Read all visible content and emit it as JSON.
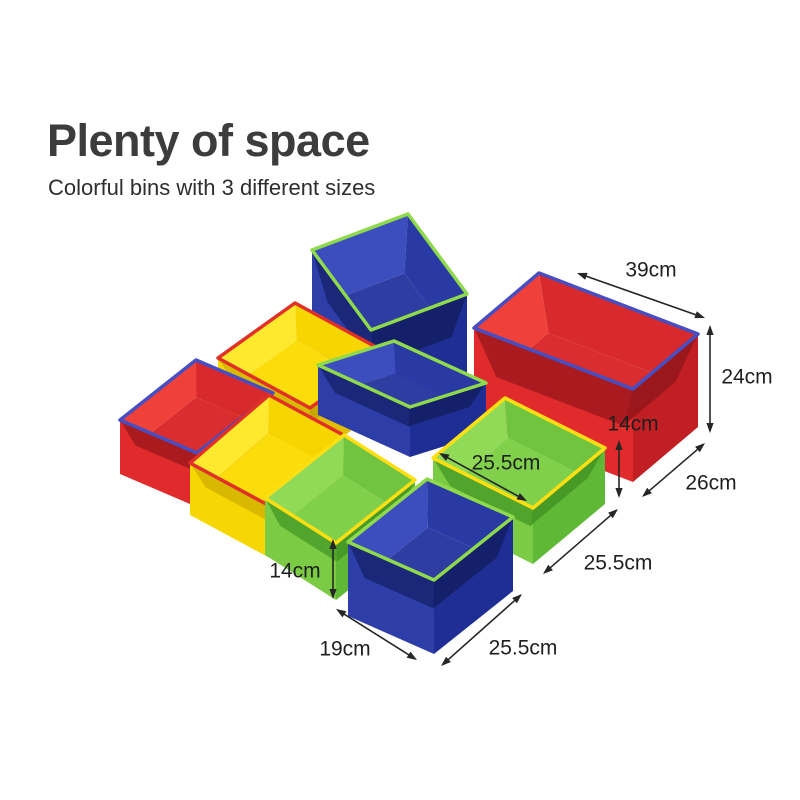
{
  "header": {
    "title": "Plenty of space",
    "subtitle": "Colorful bins with 3 different sizes"
  },
  "palette": {
    "background": "#ffffff",
    "annotation": "#262626",
    "families": {
      "blue": {
        "outer_left": "#2e3ea9",
        "outer_right": "#1f2e95",
        "inner_far_left": "#3c4dbd",
        "inner_far_right": "#2a3aa4",
        "floor": "#2d3da1",
        "inner_near_left": "#1b2779",
        "inner_near_right": "#15206a"
      },
      "red": {
        "outer_left": "#e02a2c",
        "outer_right": "#c11f24",
        "inner_far_left": "#ef403a",
        "inner_far_right": "#d8292d",
        "floor": "#d92d2f",
        "inner_near_left": "#aa1b1f",
        "inner_near_right": "#9a171b"
      },
      "yellow": {
        "outer_left": "#f6d703",
        "outer_right": "#e0bd00",
        "inner_far_left": "#ffe92e",
        "inner_far_right": "#f6d500",
        "floor": "#fadd0a",
        "inner_near_left": "#d9b800",
        "inner_near_right": "#c7a700"
      },
      "green": {
        "outer_left": "#7bcb45",
        "outer_right": "#5fb836",
        "inner_far_left": "#90da58",
        "inner_far_right": "#71c43f",
        "floor": "#80d04b",
        "inner_near_left": "#52a52c",
        "inner_near_right": "#479a26"
      }
    },
    "trims": {
      "green": "#8ed94c",
      "red": "#e03028",
      "blue": "#474ec2",
      "yellow": "#ffdf12"
    }
  },
  "figure": {
    "canvas": {
      "width": 800,
      "height": 800
    },
    "bins": [
      {
        "name": "blue-large-back",
        "color": "blue",
        "trim": "green",
        "front": [
          371,
          330
        ],
        "edge_left": [
          -59,
          -80
        ],
        "edge_right": [
          96,
          -36
        ],
        "height": 92
      },
      {
        "name": "yellow-back",
        "color": "yellow",
        "trim": "red",
        "front": [
          310,
          408
        ],
        "edge_left": [
          -92,
          -50
        ],
        "edge_right": [
          77,
          -55
        ],
        "height": 52
      },
      {
        "name": "red-large-right",
        "color": "red",
        "trim": "blue",
        "front": [
          633,
          389
        ],
        "edge_left": [
          -159,
          -61
        ],
        "edge_right": [
          65,
          -55
        ],
        "height": 93
      },
      {
        "name": "blue-mid",
        "color": "blue",
        "trim": "green",
        "front": [
          410,
          407
        ],
        "edge_left": [
          -92,
          -42
        ],
        "edge_right": [
          76,
          -24
        ],
        "height": 50
      },
      {
        "name": "red-left",
        "color": "red",
        "trim": "blue",
        "front": [
          197,
          453
        ],
        "edge_left": [
          -77,
          -33
        ],
        "edge_right": [
          76,
          -60
        ],
        "height": 54
      },
      {
        "name": "yellow-front",
        "color": "yellow",
        "trim": "red",
        "front": [
          268,
          505
        ],
        "edge_left": [
          -78,
          -42
        ],
        "edge_right": [
          79,
          -68
        ],
        "height": 52
      },
      {
        "name": "green-right",
        "color": "green",
        "trim": "yellow",
        "front": [
          533,
          508
        ],
        "edge_left": [
          -100,
          -50
        ],
        "edge_right": [
          72,
          -60
        ],
        "height": 56
      },
      {
        "name": "green-left",
        "color": "green",
        "trim": "yellow",
        "front": [
          336,
          543
        ],
        "edge_left": [
          -71,
          -45
        ],
        "edge_right": [
          79,
          -63
        ],
        "height": 57
      },
      {
        "name": "blue-front",
        "color": "blue",
        "trim": "green",
        "front": [
          434,
          580
        ],
        "edge_left": [
          -86,
          -38
        ],
        "edge_right": [
          79,
          -63
        ],
        "height": 74
      }
    ],
    "dimensions": [
      {
        "name": "width-39cm",
        "label": "39cm",
        "label_pos": [
          651,
          271
        ],
        "arrow": [
          577,
          273,
          705,
          318
        ]
      },
      {
        "name": "height-24cm",
        "label": "24cm",
        "label_pos": [
          747,
          378
        ],
        "arrow": [
          710,
          325,
          710,
          433
        ]
      },
      {
        "name": "height-14cm-right",
        "label": "14cm",
        "label_pos": [
          633,
          425
        ],
        "arrow": [
          619,
          440,
          619,
          498
        ]
      },
      {
        "name": "depth-26cm",
        "label": "26cm",
        "label_pos": [
          711,
          484
        ],
        "arrow": [
          642,
          497,
          705,
          443
        ]
      },
      {
        "name": "depth-25-5cm-right",
        "label": "25.5cm",
        "label_pos": [
          618,
          564
        ],
        "arrow": [
          543,
          574,
          618,
          509
        ]
      },
      {
        "name": "width-25-5cm-inside",
        "label": "25.5cm",
        "label_pos": [
          506,
          464
        ],
        "arrow": [
          439,
          453,
          527,
          501
        ]
      },
      {
        "name": "height-14cm-left",
        "label": "14cm",
        "label_pos": [
          295,
          572
        ],
        "arrow": [
          333,
          539,
          333,
          599
        ]
      },
      {
        "name": "width-19cm",
        "label": "19cm",
        "label_pos": [
          345,
          650
        ],
        "arrow": [
          336,
          609,
          417,
          660
        ]
      },
      {
        "name": "depth-25-5cm-bottom",
        "label": "25.5cm",
        "label_pos": [
          523,
          649
        ],
        "arrow": [
          441,
          666,
          522,
          594
        ]
      }
    ]
  }
}
